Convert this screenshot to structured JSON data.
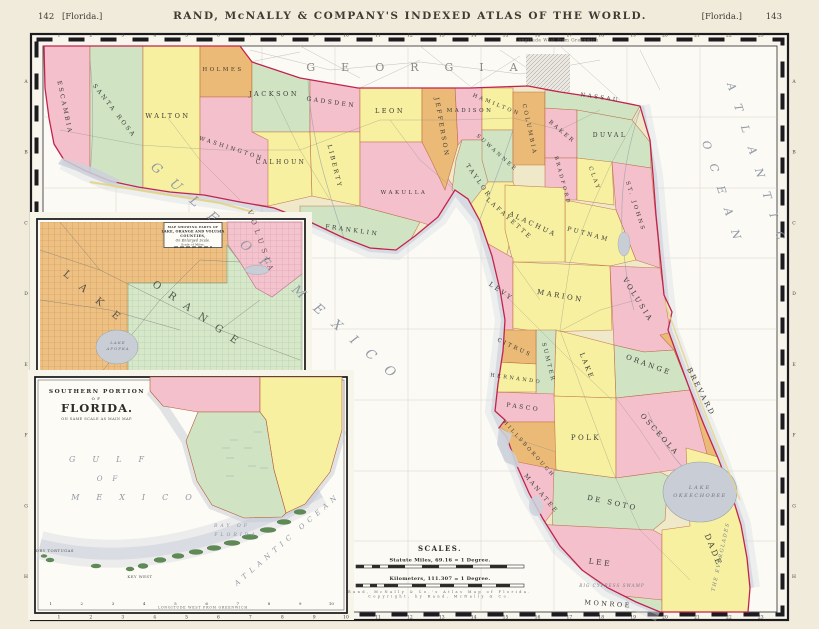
{
  "page": {
    "page_number_left": "142",
    "page_label_left": "[Florida.]",
    "header_title": "RAND, McNALLY & COMPANY'S INDEXED ATLAS OF THE WORLD.",
    "page_label_right": "[Florida.]",
    "page_number_right": "143"
  },
  "map": {
    "border": {
      "top_numbers": [
        "1",
        "2",
        "3",
        "4",
        "5",
        "6",
        "7",
        "8",
        "9",
        "10",
        "11",
        "12",
        "13",
        "14",
        "15",
        "16",
        "17",
        "18",
        "19",
        "20",
        "21",
        "22",
        "23"
      ],
      "bottom_numbers": [
        "1",
        "2",
        "3",
        "4",
        "5",
        "6",
        "7",
        "8",
        "9",
        "10",
        "11",
        "12",
        "13",
        "14",
        "15",
        "16",
        "17",
        "18",
        "19",
        "20",
        "21",
        "22",
        "23"
      ],
      "side_letters": [
        "A",
        "B",
        "C",
        "D",
        "E",
        "F",
        "G",
        "H"
      ]
    }
  },
  "inset_southern": {
    "bottom_numbers": [
      "1",
      "2",
      "3",
      "4",
      "5",
      "6",
      "7",
      "8",
      "9",
      "10"
    ],
    "bottom_note": "LONGITUDE WEST FROM GREENWICH"
  },
  "colors": {
    "county_pink": "#f3c0cb",
    "county_yellow": "#f6f0a0",
    "county_green": "#d0e4c4",
    "county_orange": "#eaba76",
    "state_boundary_red": "#c2234d",
    "water_gray": "#c9cdd5",
    "ocean_white": "#fbfaf4"
  },
  "labels": [
    {
      "n": "georgia",
      "t": "GEORGIA",
      "x": 425,
      "y": 71,
      "s": 11,
      "ls": 26,
      "c": "#8d8a80",
      "w": 500
    },
    {
      "n": "longitude-note",
      "t": "Longitude West from Greenwich",
      "x": 557,
      "y": 41.5,
      "s": 4.2,
      "ls": 0.5,
      "c": "#6a675f",
      "w": 400
    },
    {
      "n": "gulf-of-mexico",
      "t": "GULF OF MEXICO",
      "x": 150,
      "y": 168,
      "r": 41,
      "s": 13,
      "ls": 15,
      "c": "#959aa6",
      "i": true,
      "a": "start",
      "w": 400
    },
    {
      "n": "atlantic",
      "t": "ATLANTIC",
      "x": 727,
      "y": 84,
      "r": 72,
      "s": 11,
      "ls": 15,
      "c": "#9298a4",
      "i": true,
      "a": "start",
      "w": 400
    },
    {
      "n": "ocean",
      "t": "OCEAN",
      "x": 702,
      "y": 142,
      "r": 72,
      "s": 11,
      "ls": 15,
      "c": "#9298a4",
      "i": true,
      "a": "start",
      "w": 400
    },
    {
      "n": "county-escambia",
      "t": "ESCAMBIA",
      "x": 63,
      "y": 108,
      "r": 78,
      "s": 6
    },
    {
      "n": "county-santa-rosa",
      "t": "SANTA ROSA",
      "x": 113,
      "y": 112,
      "r": 52,
      "s": 6
    },
    {
      "n": "county-walton",
      "t": "WALTON",
      "x": 168,
      "y": 118,
      "s": 6.5
    },
    {
      "n": "county-holmes",
      "t": "HOLMES",
      "x": 223,
      "y": 71,
      "s": 5.5
    },
    {
      "n": "county-washington",
      "t": "WASHINGTON",
      "x": 231,
      "y": 150,
      "r": 18,
      "s": 5.5
    },
    {
      "n": "county-jackson",
      "t": "JACKSON",
      "x": 274,
      "y": 96,
      "s": 6.5
    },
    {
      "n": "county-calhoun",
      "t": "CALHOUN",
      "x": 281,
      "y": 164,
      "s": 6
    },
    {
      "n": "county-gadsden",
      "t": "GADSDEN",
      "x": 331,
      "y": 104,
      "r": 8,
      "s": 6
    },
    {
      "n": "county-liberty",
      "t": "LIBERTY",
      "x": 333,
      "y": 167,
      "r": 76,
      "s": 6
    },
    {
      "n": "county-franklin",
      "t": "FRANKLIN",
      "x": 352,
      "y": 232,
      "r": 8,
      "s": 6
    },
    {
      "n": "county-leon",
      "t": "LEON",
      "x": 390,
      "y": 113,
      "s": 6.5
    },
    {
      "n": "county-wakulla",
      "t": "WAKULLA",
      "x": 404,
      "y": 194,
      "s": 5.5
    },
    {
      "n": "county-jefferson",
      "t": "JEFFERSON",
      "x": 440,
      "y": 128,
      "r": 80,
      "s": 6
    },
    {
      "n": "county-madison",
      "t": "MADISON",
      "x": 470,
      "y": 112,
      "s": 5.5
    },
    {
      "n": "county-taylor",
      "t": "TAYLOR",
      "x": 477,
      "y": 182,
      "r": 55,
      "s": 6
    },
    {
      "n": "county-lafayette",
      "t": "LAFAYETTE",
      "x": 508,
      "y": 220,
      "r": 42,
      "s": 6
    },
    {
      "n": "county-suwannee",
      "t": "SUWANNEE",
      "x": 496,
      "y": 154,
      "r": 42,
      "s": 5.2
    },
    {
      "n": "county-hamilton",
      "t": "HAMILTON",
      "x": 496,
      "y": 106,
      "r": 22,
      "s": 5.2
    },
    {
      "n": "county-columbia",
      "t": "COLUMBIA",
      "x": 528,
      "y": 130,
      "r": 78,
      "s": 5.5
    },
    {
      "n": "county-baker",
      "t": "BAKER",
      "x": 561,
      "y": 133,
      "r": 40,
      "s": 5.5
    },
    {
      "n": "county-nassau",
      "t": "NASSAU",
      "x": 600,
      "y": 99,
      "r": 8,
      "s": 5.5
    },
    {
      "n": "county-duval",
      "t": "DUVAL",
      "x": 610,
      "y": 137,
      "s": 6
    },
    {
      "n": "county-bradford",
      "t": "BRADFORD",
      "x": 561,
      "y": 181,
      "r": 75,
      "s": 5
    },
    {
      "n": "county-clay",
      "t": "CLAY",
      "x": 593,
      "y": 179,
      "r": 70,
      "s": 5.5
    },
    {
      "n": "county-st-johns",
      "t": "ST. JOHNS",
      "x": 634,
      "y": 207,
      "r": 72,
      "s": 5.5
    },
    {
      "n": "county-putnam",
      "t": "PUTNAM",
      "x": 588,
      "y": 236,
      "r": 15,
      "s": 6
    },
    {
      "n": "county-alachua",
      "t": "ALACHUA",
      "x": 532,
      "y": 226,
      "r": 25,
      "s": 6.5
    },
    {
      "n": "county-levy",
      "t": "LEVY",
      "x": 500,
      "y": 293,
      "r": 35,
      "s": 6.5
    },
    {
      "n": "county-marion",
      "t": "MARION",
      "x": 560,
      "y": 298,
      "r": 10,
      "s": 7
    },
    {
      "n": "county-volusia",
      "t": "VOLUSIA",
      "x": 636,
      "y": 301,
      "r": 58,
      "s": 7
    },
    {
      "n": "county-lake",
      "t": "LAKE",
      "x": 585,
      "y": 367,
      "r": 68,
      "s": 6.5
    },
    {
      "n": "county-sumter",
      "t": "SUMTER",
      "x": 547,
      "y": 363,
      "r": 76,
      "s": 5.5
    },
    {
      "n": "county-citrus",
      "t": "CITRUS",
      "x": 514,
      "y": 349,
      "r": 25,
      "s": 5.5
    },
    {
      "n": "county-hernando",
      "t": "HERNANDO",
      "x": 516,
      "y": 380,
      "r": 8,
      "s": 5
    },
    {
      "n": "county-pasco",
      "t": "PASCO",
      "x": 523,
      "y": 409,
      "r": 8,
      "s": 6
    },
    {
      "n": "county-orange",
      "t": "ORANGE",
      "x": 648,
      "y": 367,
      "r": 20,
      "s": 7
    },
    {
      "n": "county-brevard",
      "t": "BREVARD",
      "x": 699,
      "y": 393,
      "r": 63,
      "s": 7
    },
    {
      "n": "county-hillsborough",
      "t": "HILLSBOROUGH",
      "x": 528,
      "y": 450,
      "r": 48,
      "s": 5
    },
    {
      "n": "county-polk",
      "t": "POLK",
      "x": 586,
      "y": 440,
      "s": 7
    },
    {
      "n": "county-osceola",
      "t": "OSCEOLA",
      "x": 658,
      "y": 436,
      "r": 48,
      "s": 7
    },
    {
      "n": "county-manatee",
      "t": "MANATEE",
      "x": 540,
      "y": 495,
      "r": 50,
      "s": 6
    },
    {
      "n": "county-de-soto",
      "t": "DE SOTO",
      "x": 612,
      "y": 505,
      "r": 12,
      "s": 7
    },
    {
      "n": "county-lee",
      "t": "LEE",
      "x": 600,
      "y": 565,
      "r": 8,
      "s": 7.5
    },
    {
      "n": "county-dade",
      "t": "DADE",
      "x": 711,
      "y": 551,
      "r": 68,
      "s": 8
    },
    {
      "n": "county-monroe",
      "t": "MONROE",
      "x": 608,
      "y": 606,
      "r": 4,
      "s": 6.5
    },
    {
      "n": "lake-okeechobee-line1",
      "t": "LAKE",
      "x": 700,
      "y": 489,
      "s": 5,
      "ls": 2,
      "c": "#70747e",
      "i": true,
      "w": 400
    },
    {
      "n": "lake-okeechobee-line2",
      "t": "OKEECHOBEE",
      "x": 700,
      "y": 497,
      "s": 5,
      "ls": 1.5,
      "c": "#70747e",
      "i": true,
      "w": 400
    },
    {
      "n": "the-everglades",
      "t": "THE EVERGLADES",
      "x": 722,
      "y": 557,
      "r": -78,
      "s": 5,
      "ls": 1.5,
      "c": "#7c8088",
      "i": true,
      "w": 400
    },
    {
      "n": "big-cypress-swamp",
      "t": "BIG CYPRESS SWAMP",
      "x": 612,
      "y": 587,
      "s": 4.2,
      "ls": 1,
      "c": "#7c8088",
      "i": true,
      "w": 400
    },
    {
      "n": "inset1-title-line1",
      "t": "MAP SHOWING PARTS OF",
      "x": 193,
      "y": 228,
      "s": 3,
      "ls": 0.3,
      "w": 600,
      "c": "#333330"
    },
    {
      "n": "inset1-title-line2",
      "t": "LAKE, ORANGE AND VOLUSIA",
      "x": 193,
      "y": 232.5,
      "s": 3.4,
      "ls": 0.2,
      "w": 700,
      "c": "#2f2c28"
    },
    {
      "n": "inset1-title-line3",
      "t": "COUNTIES,",
      "x": 193,
      "y": 237,
      "s": 3.4,
      "ls": 0.4,
      "w": 700,
      "c": "#2f2c28"
    },
    {
      "n": "inset1-title-line4",
      "t": "On Enlarged Scale.",
      "x": 193,
      "y": 241.5,
      "s": 3.2,
      "ls": 0.2,
      "i": true,
      "c": "#333330"
    },
    {
      "n": "inset1-title-line5",
      "t": "Scale of Miles.",
      "x": 193,
      "y": 245.5,
      "s": 2.8,
      "ls": 0.2,
      "c": "#333330"
    },
    {
      "n": "inset1-lake",
      "t": "LAKE",
      "x": 95,
      "y": 302,
      "r": 40,
      "s": 10,
      "ls": 14,
      "c": "#5c5348"
    },
    {
      "n": "inset1-orange",
      "t": "ORANGE",
      "x": 198,
      "y": 318,
      "r": 35,
      "s": 10,
      "ls": 11,
      "c": "#4d5a48"
    },
    {
      "n": "inset1-volusia",
      "t": "VOLUSIA",
      "x": 259,
      "y": 243,
      "r": 70,
      "s": 7,
      "ls": 5,
      "c": "#6e5560"
    },
    {
      "n": "inset1-lake-apopka-line1",
      "t": "LAKE",
      "x": 118,
      "y": 344,
      "s": 4,
      "ls": 1,
      "c": "#70747e",
      "i": true,
      "w": 400
    },
    {
      "n": "inset1-lake-apopka-line2",
      "t": "APOPKA",
      "x": 118,
      "y": 350,
      "s": 4,
      "ls": 1,
      "c": "#70747e",
      "i": true,
      "w": 400
    },
    {
      "n": "inset2-title-line1",
      "t": "SOUTHERN PORTION",
      "x": 97,
      "y": 393,
      "s": 5.8,
      "ls": 1.5,
      "w": 700,
      "c": "#2f2c28"
    },
    {
      "n": "inset2-title-line2",
      "t": "OF",
      "x": 97,
      "y": 400,
      "s": 3.8,
      "c": "#2f2c28"
    },
    {
      "n": "inset2-title-line3",
      "t": "FLORIDA.",
      "x": 97,
      "y": 412,
      "s": 11.5,
      "ls": 1,
      "w": 700,
      "c": "#2f2c28"
    },
    {
      "n": "inset2-title-line4",
      "t": "ON SAME SCALE AS MAIN MAP.",
      "x": 97,
      "y": 420,
      "s": 3.6,
      "ls": 0.4,
      "c": "#55524a"
    },
    {
      "n": "inset2-gulf",
      "t": "GULF",
      "x": 115,
      "y": 462,
      "s": 8,
      "ls": 17,
      "c": "#9298a4",
      "i": true,
      "w": 400
    },
    {
      "n": "inset2-of",
      "t": "OF",
      "x": 112,
      "y": 481,
      "s": 7,
      "ls": 10,
      "c": "#9298a4",
      "i": true,
      "w": 400
    },
    {
      "n": "inset2-mexico",
      "t": "MEXICO",
      "x": 140,
      "y": 500,
      "s": 8,
      "ls": 17,
      "c": "#9298a4",
      "i": true,
      "w": 400
    },
    {
      "n": "inset2-bay-of",
      "t": "BAY OF",
      "x": 232,
      "y": 527,
      "s": 4.6,
      "ls": 3,
      "c": "#8d929e",
      "i": true,
      "w": 400
    },
    {
      "n": "inset2-florida-bay",
      "t": "FLORIDA",
      "x": 236,
      "y": 536,
      "s": 4.6,
      "ls": 3,
      "c": "#8d929e",
      "i": true,
      "w": 400
    },
    {
      "n": "inset2-atlantic-ocean",
      "t": "ATLANTIC OCEAN",
      "x": 237,
      "y": 586,
      "r": -41,
      "s": 7,
      "ls": 5,
      "c": "#9298a4",
      "i": true,
      "a": "start",
      "w": 400
    },
    {
      "n": "inset2-key-west",
      "t": "KEY WEST",
      "x": 140,
      "y": 578,
      "s": 3.8,
      "ls": 0.5,
      "c": "#55524a",
      "w": 400
    },
    {
      "n": "inset2-dry-tortugas",
      "t": "DRY TORTUGAS",
      "x": 55,
      "y": 552,
      "s": 3.8,
      "ls": 0.5,
      "c": "#55524a",
      "w": 400
    },
    {
      "n": "scales-title",
      "t": "SCALES.",
      "x": 440,
      "y": 551,
      "s": 7,
      "ls": 1.5,
      "w": 700,
      "c": "#2f2c28"
    },
    {
      "n": "scales-statute-miles",
      "t": "Statute Miles, 69.16 = 1 Degree.",
      "x": 440,
      "y": 561.5,
      "s": 5,
      "ls": 0.3,
      "w": 600,
      "c": "#2f2c28"
    },
    {
      "n": "scales-kilometers",
      "t": "Kilometers, 111.307 = 1 Degree.",
      "x": 440,
      "y": 580,
      "s": 5,
      "ls": 0.3,
      "w": 600,
      "c": "#2f2c28"
    },
    {
      "n": "scales-copyright-line1",
      "t": "Rand, McNally & Co.'s Atlas Map of Florida.",
      "x": 440,
      "y": 593,
      "s": 3.4,
      "c": "#6a675f",
      "w": 400
    },
    {
      "n": "scales-copyright-line2",
      "t": "Copyright, by Rand, McNally & Co.",
      "x": 440,
      "y": 597.5,
      "s": 3.4,
      "c": "#6a675f",
      "w": 400
    }
  ]
}
